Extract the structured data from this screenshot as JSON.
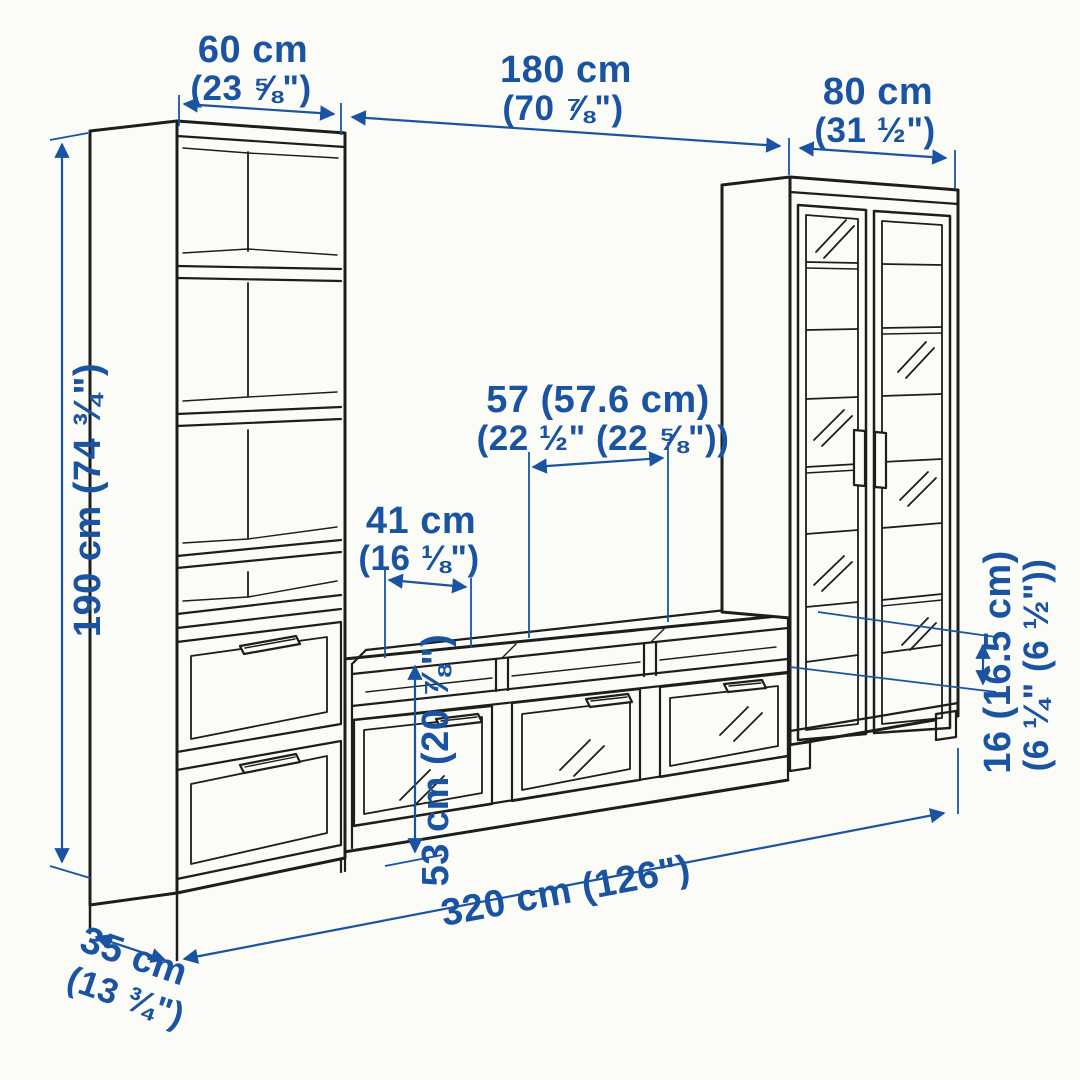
{
  "title": "TV storage combination dimension diagram",
  "colors": {
    "dimension_blue": "#1a53a2",
    "outline_black": "#1d1d1b",
    "background": "#fbfbf8"
  },
  "dims": {
    "bookcase_width": {
      "cm": "60 cm",
      "inch": "(23 ⅝\")"
    },
    "bench_width": {
      "cm": "180 cm",
      "inch": "(70 ⅞\")"
    },
    "cabinet_width": {
      "cm": "80 cm",
      "inch": "(31 ½\")"
    },
    "total_height": {
      "label": "190 cm (74 ¾\")"
    },
    "tv_space_width": {
      "cm": "57 (57.6 cm)",
      "inch": "(22 ½\" (22 ⅝\"))"
    },
    "compartment_width": {
      "cm": "41 cm",
      "inch": "(16 ⅛\")"
    },
    "bench_height": {
      "label": "53 cm (20 ⅞\")"
    },
    "shelf_spacing": {
      "cm": "16 (16.5 cm)",
      "inch": "(6 ¼\" (6 ½\"))"
    },
    "total_width": {
      "label": "320 cm (126\")"
    },
    "depth": {
      "cm": "35 cm",
      "inch": "(13 ¾\")"
    }
  }
}
